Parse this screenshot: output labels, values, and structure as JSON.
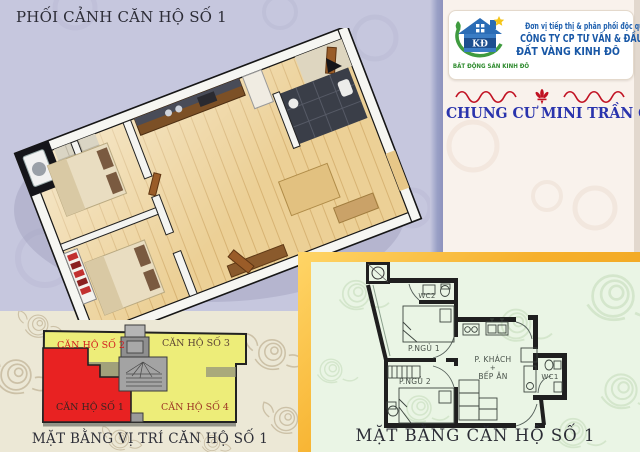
{
  "page": {
    "width": 640,
    "height": 452
  },
  "colors": {
    "lavender_bg": "#c6c7de",
    "cream_bg": "#ece8d6",
    "right_panel_bg": "#f9f2ec",
    "mint_bg": "#eaf5e5",
    "gold_frame": "#f6b02c",
    "unit_yellow": "#eeee85",
    "unit_red": "#e42222",
    "core_gray": "#a3a3a3",
    "brand_blue": "#1d5fae",
    "project_title_blue": "#2a34ad",
    "logo_green": "#2e8b2e",
    "ornament_red": "#c11122",
    "caption_dark": "#2e2f38",
    "wood_floor": "#ecd096"
  },
  "perspective": {
    "title": "PHỐI CẢNH CĂN HỘ SỐ 1"
  },
  "brand": {
    "logo_monogram": "KĐ",
    "logo_caption": "BẤT ĐỘNG SẢN KINH ĐÔ",
    "tagline": "Đơn vị tiếp thị & phân phối độc quyền",
    "company_line1": "CÔNG TY CP TƯ VẤN & ĐẦU TƯ",
    "company_line2": "ĐẤT VÀNG KINH ĐÔ",
    "project_title": "CHUNG CƯ MINI TRẦN CUNG"
  },
  "location_plan": {
    "caption": "MẶT BẰNG VỊ TRÍ CĂN HỘ SỐ 1",
    "units": [
      {
        "label": "CĂN HỘ SỐ 2",
        "highlight": false
      },
      {
        "label": "CĂN HỘ SỐ 3",
        "highlight": false
      },
      {
        "label": "CĂN HỘ SỐ 1",
        "highlight": true
      },
      {
        "label": "CĂN HỘ SỐ 4",
        "highlight": false
      }
    ]
  },
  "floor_plan": {
    "caption": "MẶT BẰNG CĂN HỘ SỐ 1",
    "rooms": {
      "wc2": "WC2",
      "bedroom1": "P.NGỦ 1",
      "bedroom2": "P.NGỦ 2",
      "living": "P. KHÁCH",
      "plus": "+",
      "kitchen": "BẾP ĂN",
      "wc1": "WC1"
    }
  }
}
